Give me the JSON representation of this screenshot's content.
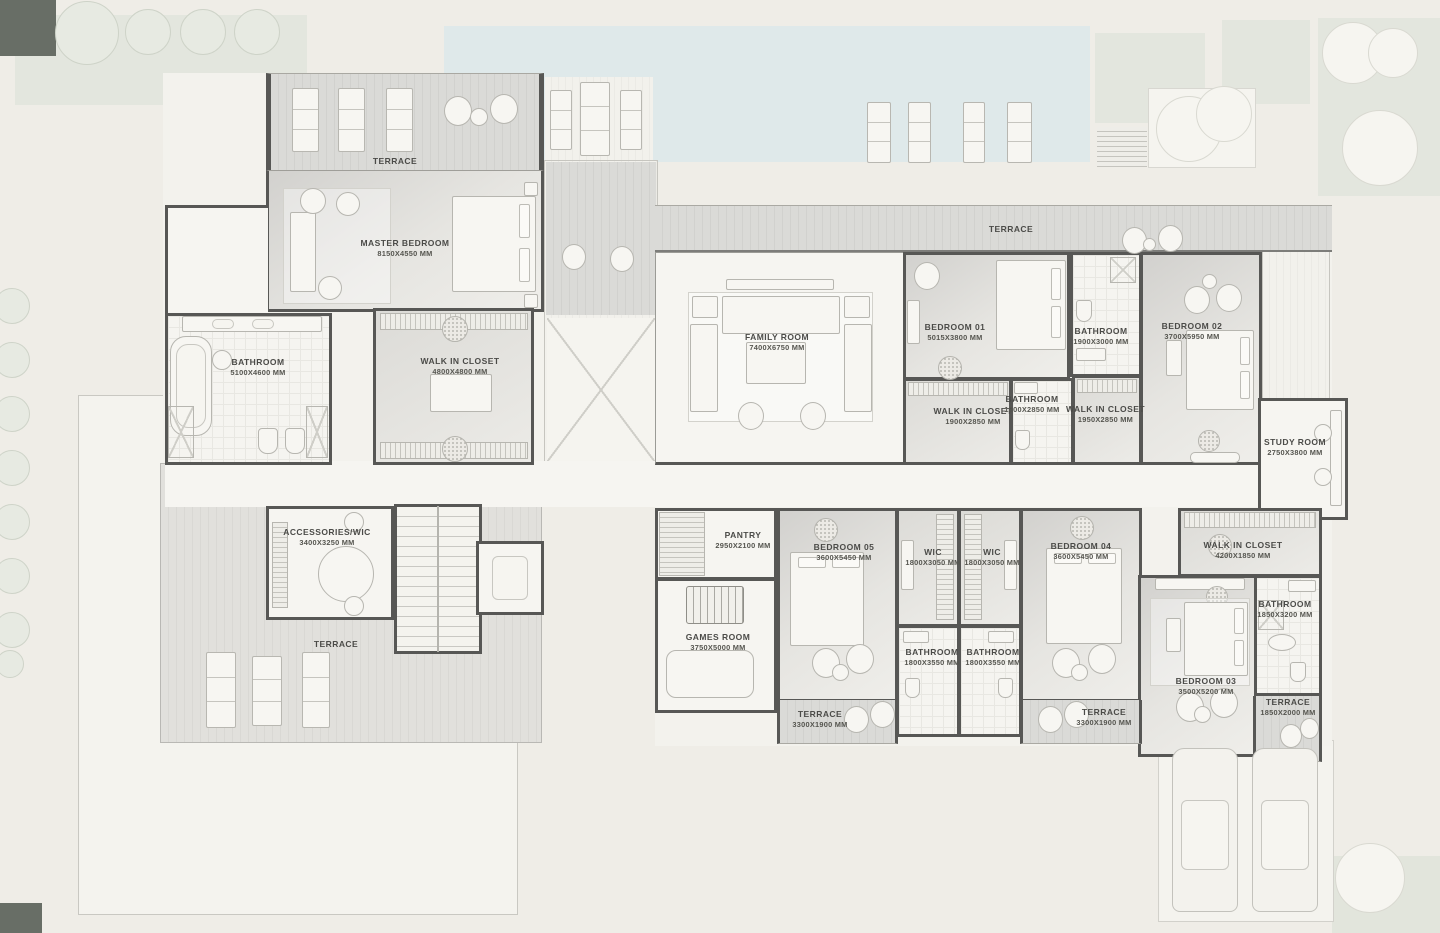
{
  "palette": {
    "wall": "#575755",
    "pool": "#dfe9ea",
    "floor": "#f6f5f1",
    "terrace": "#d8d8d5",
    "background": "#efede7"
  },
  "rooms": [
    {
      "name": "TERRACE",
      "dims": ""
    },
    {
      "name": "MASTER BEDROOM",
      "dims": "8150x4550 mm"
    },
    {
      "name": "BATHROOM",
      "dims": "5100x4600 mm"
    },
    {
      "name": "WALK IN CLOSET",
      "dims": "4800x4800 mm"
    },
    {
      "name": "ACCESSORIES/WIC",
      "dims": "3400x3250 mm"
    },
    {
      "name": "TERRACE",
      "dims": ""
    },
    {
      "name": "FAMILY ROOM",
      "dims": "7400x6750 mm"
    },
    {
      "name": "TERRACE",
      "dims": ""
    },
    {
      "name": "BEDROOM 01",
      "dims": "5015x3800 mm"
    },
    {
      "name": "BATHROOM",
      "dims": "1900x3000 mm"
    },
    {
      "name": "BEDROOM 02",
      "dims": "3700x5950 mm"
    },
    {
      "name": "WALK IN CLOSET",
      "dims": "1900x2850 mm"
    },
    {
      "name": "BATHROOM",
      "dims": "1800x2850 mm"
    },
    {
      "name": "WALK IN CLOSET",
      "dims": "1950x2850 mm"
    },
    {
      "name": "STUDY ROOM",
      "dims": "2750x3800 mm"
    },
    {
      "name": "PANTRY",
      "dims": "2950x2100 mm"
    },
    {
      "name": "GAMES ROOM",
      "dims": "3750x5000 mm"
    },
    {
      "name": "BEDROOM 05",
      "dims": "3600x5450 mm"
    },
    {
      "name": "WIC",
      "dims": "1800x3050 mm"
    },
    {
      "name": "WIC",
      "dims": "1800x3050 mm"
    },
    {
      "name": "BATHROOM",
      "dims": "1800x3550 mm"
    },
    {
      "name": "BATHROOM",
      "dims": "1800x3550 mm"
    },
    {
      "name": "BEDROOM 04",
      "dims": "3600x5450 mm"
    },
    {
      "name": "WALK IN CLOSET",
      "dims": "4200x1850 mm"
    },
    {
      "name": "BATHROOM",
      "dims": "1850x3200 mm"
    },
    {
      "name": "BEDROOM 03",
      "dims": "3500x5200 mm"
    },
    {
      "name": "TERRACE",
      "dims": "3300x1900 mm"
    },
    {
      "name": "TERRACE",
      "dims": "3300x1900 mm"
    },
    {
      "name": "TERRACE",
      "dims": "1850x2000 mm"
    }
  ]
}
